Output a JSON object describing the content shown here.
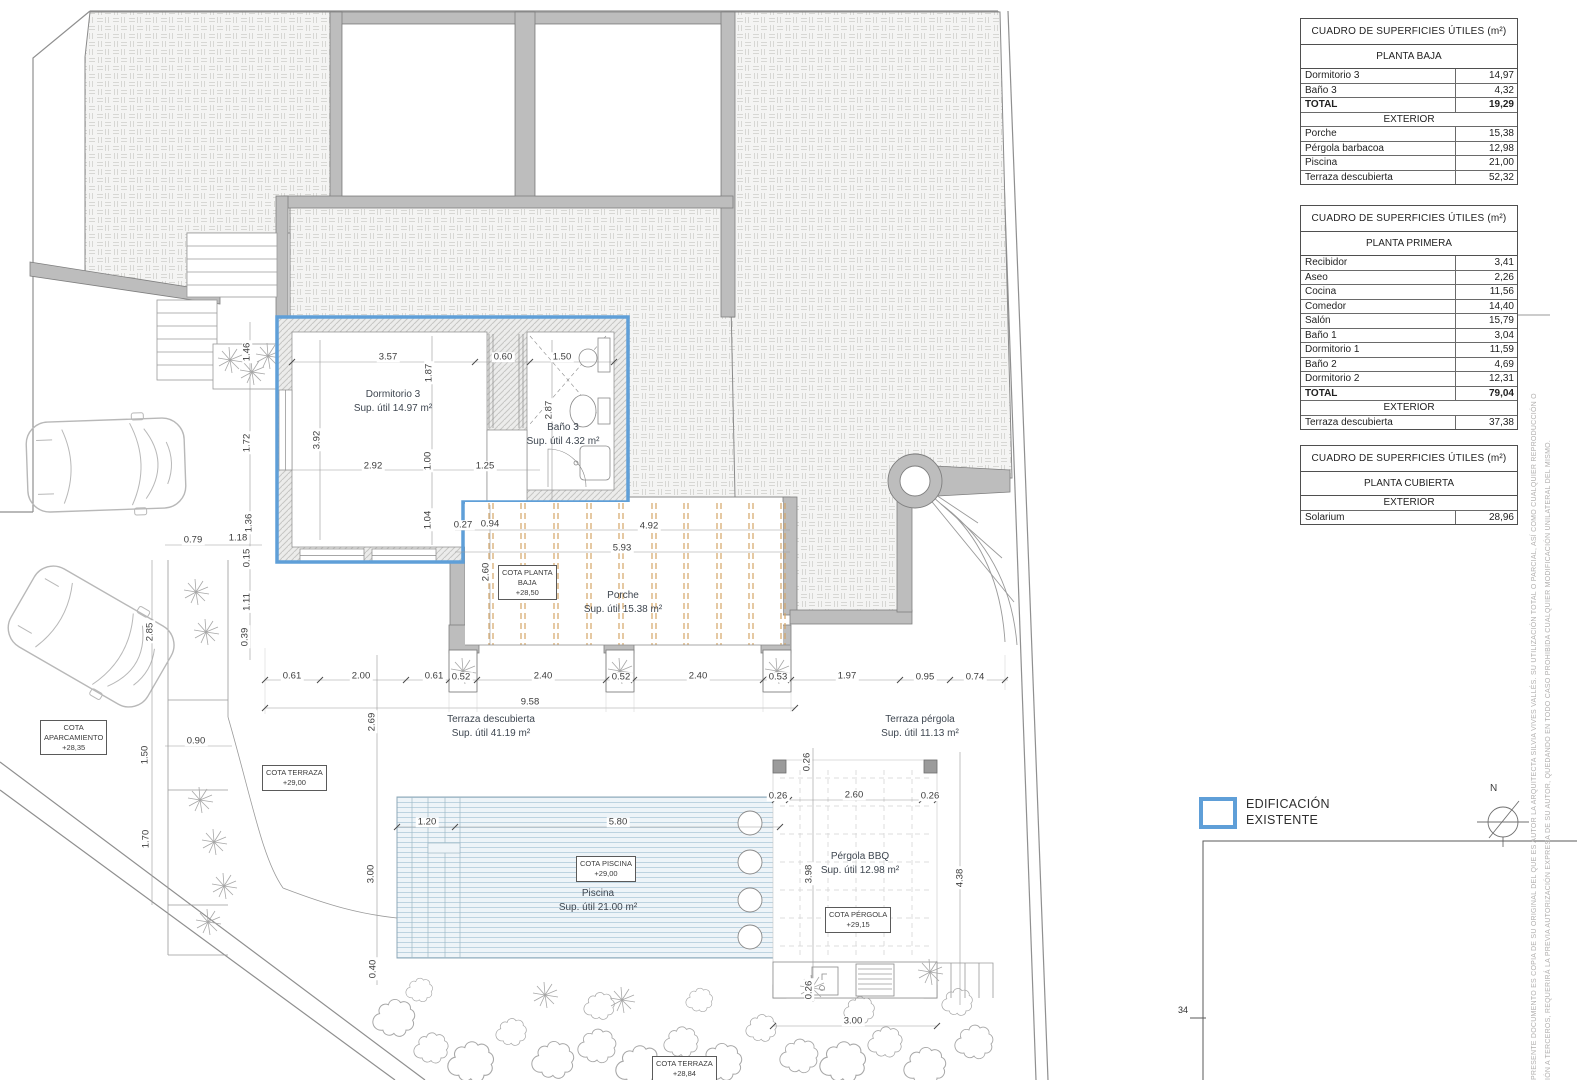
{
  "drawing": {
    "legend": {
      "swatch_color": "#5f9fd8",
      "line1": "EDIFICACIÓN",
      "line2": "EXISTENTE"
    },
    "compass": {
      "label": "N"
    },
    "sheet_number": "34",
    "disclaimer": {
      "line1": "PRESENTE DOCUMENTO ES COPIA DE SU ORIGINAL DEL QUE ES AUTOR LA ARQUITECTA SILVIA VIVES VALLÉS. SU UTILIZACIÓN TOTAL O PARCIAL, ASÍ COMO CUALQUIER REPRODUCCIÓN O",
      "line2": "IÓN A TERCEROS, REQUERIRÁ LA PREVIA AUTORIZACIÓN EXPRESA DE SU AUTOR, QUEDANDO EN TODO CASO PROHIBIDA CUALQUIER MODIFICACIÓN UNILATERAL DEL MISMO."
    },
    "colors": {
      "highlight_blue": "#5f9fd8",
      "wall_gray": "#bdbdbd",
      "beam_orange": "#d4a566",
      "pool_blue": "#bdd3e0"
    }
  },
  "tables": [
    {
      "title": "CUADRO DE SUPERFICIES ÚTILES (m²)",
      "subtitle": "PLANTA BAJA",
      "rows": [
        {
          "label": "Dormitorio 3",
          "value": "14,97"
        },
        {
          "label": "Baño 3",
          "value": "4,32"
        },
        {
          "label": "TOTAL",
          "value": "19,29",
          "cls": "total"
        },
        {
          "label": "EXTERIOR",
          "cls": "section"
        },
        {
          "label": "Porche",
          "value": "15,38"
        },
        {
          "label": "Pérgola barbacoa",
          "value": "12,98"
        },
        {
          "label": "Piscina",
          "value": "21,00"
        },
        {
          "label": "Terraza descubierta",
          "value": "52,32"
        }
      ]
    },
    {
      "title": "CUADRO DE SUPERFICIES ÚTILES (m²)",
      "subtitle": "PLANTA PRIMERA",
      "rows": [
        {
          "label": "Recibidor",
          "value": "3,41"
        },
        {
          "label": "Aseo",
          "value": "2,26"
        },
        {
          "label": "Cocina",
          "value": "11,56"
        },
        {
          "label": "Comedor",
          "value": "14,40"
        },
        {
          "label": "Salón",
          "value": "15,79"
        },
        {
          "label": "Baño 1",
          "value": "3,04"
        },
        {
          "label": "Dormitorio 1",
          "value": "11,59"
        },
        {
          "label": "Baño 2",
          "value": "4,69"
        },
        {
          "label": "Dormitorio 2",
          "value": "12,31"
        },
        {
          "label": "TOTAL",
          "value": "79,04",
          "cls": "total"
        },
        {
          "label": "EXTERIOR",
          "cls": "section"
        },
        {
          "label": "Terraza descubierta",
          "value": "37,38"
        }
      ]
    },
    {
      "title": "CUADRO DE SUPERFICIES ÚTILES (m²)",
      "subtitle": "PLANTA CUBIERTA",
      "rows": [
        {
          "label": "EXTERIOR",
          "cls": "section"
        },
        {
          "label": "Solarium",
          "value": "28,96"
        }
      ]
    }
  ],
  "room_labels": [
    {
      "l1": "Dormitorio 3",
      "l2": "Sup. útil 14.97 m²",
      "x": 393,
      "y": 388
    },
    {
      "l1": "Baño 3",
      "l2": "Sup. útil 4.32 m²",
      "x": 563,
      "y": 421
    },
    {
      "l1": "Porche",
      "l2": "Sup. útil 15.38 m²",
      "x": 623,
      "y": 589
    },
    {
      "l1": "Terraza descubierta",
      "l2": "Sup. útil 41.19 m²",
      "x": 491,
      "y": 713
    },
    {
      "l1": "Terraza pérgola",
      "l2": "Sup. útil 11.13 m²",
      "x": 920,
      "y": 713
    },
    {
      "l1": "Piscina",
      "l2": "Sup. útil 21.00 m²",
      "x": 598,
      "y": 887
    },
    {
      "l1": "Pérgola BBQ",
      "l2": "Sup. útil 12.98 m²",
      "x": 860,
      "y": 850
    }
  ],
  "cota_boxes": [
    {
      "l1": "COTA PLANTA",
      "l2": "BAJA",
      "l3": "+28,50",
      "x": 498,
      "y": 565
    },
    {
      "l1": "COTA TERRAZA",
      "l2": "+29,00",
      "l3": "",
      "x": 262,
      "y": 765
    },
    {
      "l1": "COTA PISCINA",
      "l2": "+29,00",
      "l3": "",
      "x": 576,
      "y": 856
    },
    {
      "l1": "COTA PÉRGOLA",
      "l2": "+29,15",
      "l3": "",
      "x": 825,
      "y": 907
    },
    {
      "l1": "COTA",
      "l2": "APARCAMIENTO",
      "l3": "+28,35",
      "x": 40,
      "y": 720
    },
    {
      "l1": "COTA TERRAZA",
      "l2": "+28,84",
      "l3": "",
      "x": 652,
      "y": 1056
    }
  ],
  "dims": [
    {
      "t": "1.46",
      "x": 247,
      "y": 352,
      "r": 1
    },
    {
      "t": "1.72",
      "x": 247,
      "y": 443,
      "r": 1
    },
    {
      "t": "1.36",
      "x": 249,
      "y": 523,
      "r": 1
    },
    {
      "t": "1.18",
      "x": 238,
      "y": 538
    },
    {
      "t": "0.79",
      "x": 193,
      "y": 540
    },
    {
      "t": "0.15",
      "x": 247,
      "y": 558,
      "r": 1
    },
    {
      "t": "1.11",
      "x": 247,
      "y": 602,
      "r": 1
    },
    {
      "t": "0.39",
      "x": 245,
      "y": 637,
      "r": 1
    },
    {
      "t": "2.85",
      "x": 150,
      "y": 632,
      "r": 1
    },
    {
      "t": "0.90",
      "x": 196,
      "y": 741
    },
    {
      "t": "1.50",
      "x": 145,
      "y": 755,
      "r": 1
    },
    {
      "t": "1.70",
      "x": 146,
      "y": 839,
      "r": 1
    },
    {
      "t": "3.57",
      "x": 388,
      "y": 357
    },
    {
      "t": "0.60",
      "x": 503,
      "y": 357
    },
    {
      "t": "1.50",
      "x": 562,
      "y": 357
    },
    {
      "t": "1.87",
      "x": 429,
      "y": 373,
      "r": 1
    },
    {
      "t": "3.92",
      "x": 317,
      "y": 440,
      "r": 1
    },
    {
      "t": "2.92",
      "x": 373,
      "y": 466
    },
    {
      "t": "1.00",
      "x": 428,
      "y": 461,
      "r": 1
    },
    {
      "t": "1.25",
      "x": 485,
      "y": 466
    },
    {
      "t": "2.87",
      "x": 549,
      "y": 410,
      "r": 1
    },
    {
      "t": "1.04",
      "x": 428,
      "y": 520,
      "r": 1
    },
    {
      "t": "0.27",
      "x": 463,
      "y": 525
    },
    {
      "t": "0.94",
      "x": 490,
      "y": 524
    },
    {
      "t": "4.92",
      "x": 649,
      "y": 526
    },
    {
      "t": "5.93",
      "x": 622,
      "y": 548
    },
    {
      "t": "2.60",
      "x": 486,
      "y": 572,
      "r": 1
    },
    {
      "t": "0.61",
      "x": 292,
      "y": 676
    },
    {
      "t": "2.00",
      "x": 361,
      "y": 676
    },
    {
      "t": "0.61",
      "x": 434,
      "y": 676
    },
    {
      "t": "0.52",
      "x": 461,
      "y": 677
    },
    {
      "t": "2.40",
      "x": 543,
      "y": 676
    },
    {
      "t": "0.52",
      "x": 621,
      "y": 677
    },
    {
      "t": "2.40",
      "x": 698,
      "y": 676
    },
    {
      "t": "0.53",
      "x": 778,
      "y": 677
    },
    {
      "t": "1.97",
      "x": 847,
      "y": 676
    },
    {
      "t": "0.95",
      "x": 925,
      "y": 677
    },
    {
      "t": "0.74",
      "x": 975,
      "y": 677
    },
    {
      "t": "9.58",
      "x": 530,
      "y": 702
    },
    {
      "t": "2.69",
      "x": 372,
      "y": 722,
      "r": 1
    },
    {
      "t": "1.20",
      "x": 427,
      "y": 822
    },
    {
      "t": "5.80",
      "x": 618,
      "y": 822
    },
    {
      "t": "3.00",
      "x": 371,
      "y": 874,
      "r": 1
    },
    {
      "t": "0.40",
      "x": 373,
      "y": 969,
      "r": 1
    },
    {
      "t": "0.26",
      "x": 778,
      "y": 796
    },
    {
      "t": "2.60",
      "x": 854,
      "y": 795
    },
    {
      "t": "0.26",
      "x": 930,
      "y": 796
    },
    {
      "t": "0.26",
      "x": 807,
      "y": 762,
      "r": 1
    },
    {
      "t": "3.98",
      "x": 809,
      "y": 874,
      "r": 1
    },
    {
      "t": "4.38",
      "x": 960,
      "y": 878,
      "r": 1
    },
    {
      "t": "0.26",
      "x": 809,
      "y": 990,
      "r": 1
    },
    {
      "t": "3.00",
      "x": 853,
      "y": 1021
    }
  ]
}
